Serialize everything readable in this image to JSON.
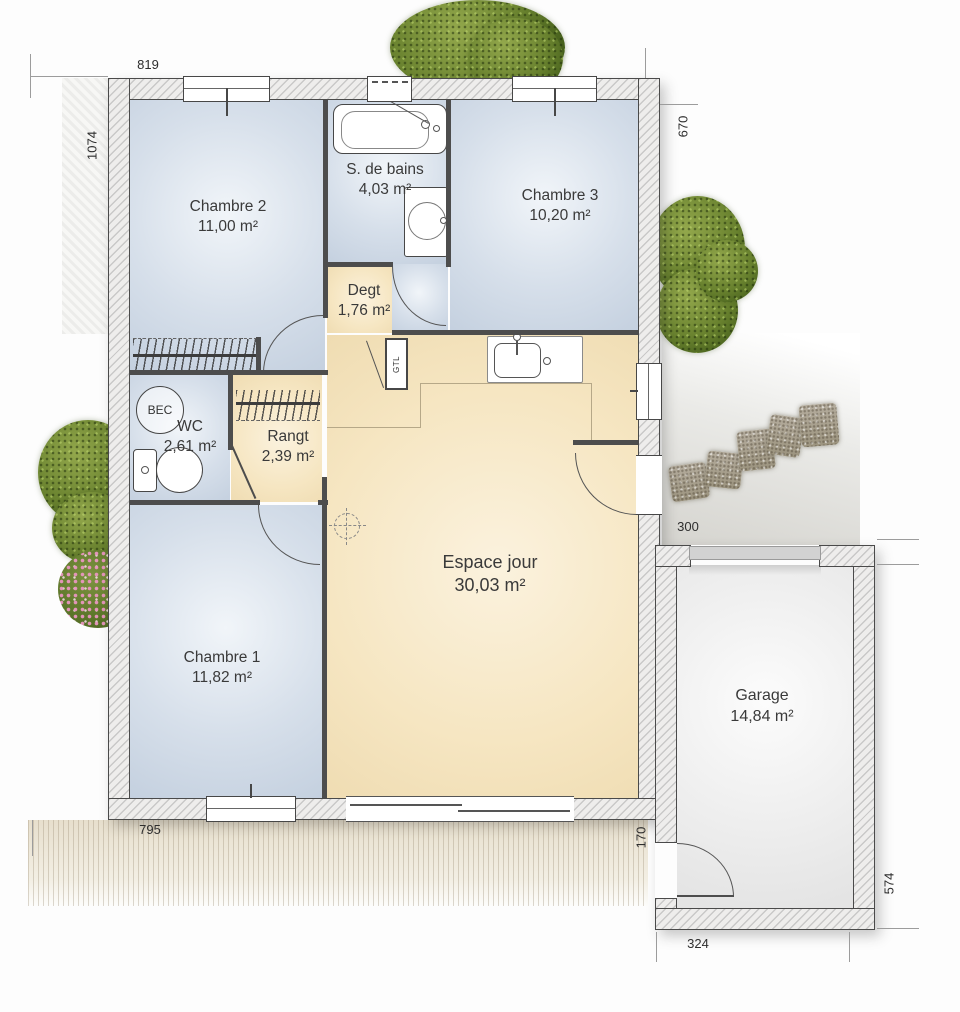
{
  "rooms": {
    "chambre2": {
      "name": "Chambre 2",
      "area": "11,00 m²"
    },
    "sdb": {
      "name": "S. de bains",
      "area": "4,03 m²"
    },
    "chambre3": {
      "name": "Chambre 3",
      "area": "10,20 m²"
    },
    "degt": {
      "name": "Degt",
      "area": "1,76 m²"
    },
    "wc": {
      "name": "WC",
      "area": "2,61 m²"
    },
    "rangt": {
      "name": "Rangt",
      "area": "2,39 m²"
    },
    "chambre1": {
      "name": "Chambre 1",
      "area": "11,82 m²"
    },
    "espace_jour": {
      "name": "Espace jour",
      "area": "30,03 m²"
    },
    "garage": {
      "name": "Garage",
      "area": "14,84 m²"
    }
  },
  "annotations": {
    "bec": "BEC",
    "gtl": "GTL"
  },
  "dimensions": {
    "top_width": "819",
    "left_height": "1074",
    "right_top_height": "670",
    "path_width": "300",
    "bottom_width": "795",
    "house_garage_gap": "170",
    "garage_width": "324",
    "garage_height": "574"
  },
  "colors": {
    "room_blue": "#cfdae7",
    "room_beige": "#f6e6c2",
    "wall_fill": "#eeedec",
    "wall_line": "#4a4a4a",
    "terrace": "#e8e0cf",
    "bush_green": "#68812e",
    "flower_pink": "#d993b8",
    "stone_gray": "#a9a192",
    "garage_door": "#d2d2d2"
  }
}
